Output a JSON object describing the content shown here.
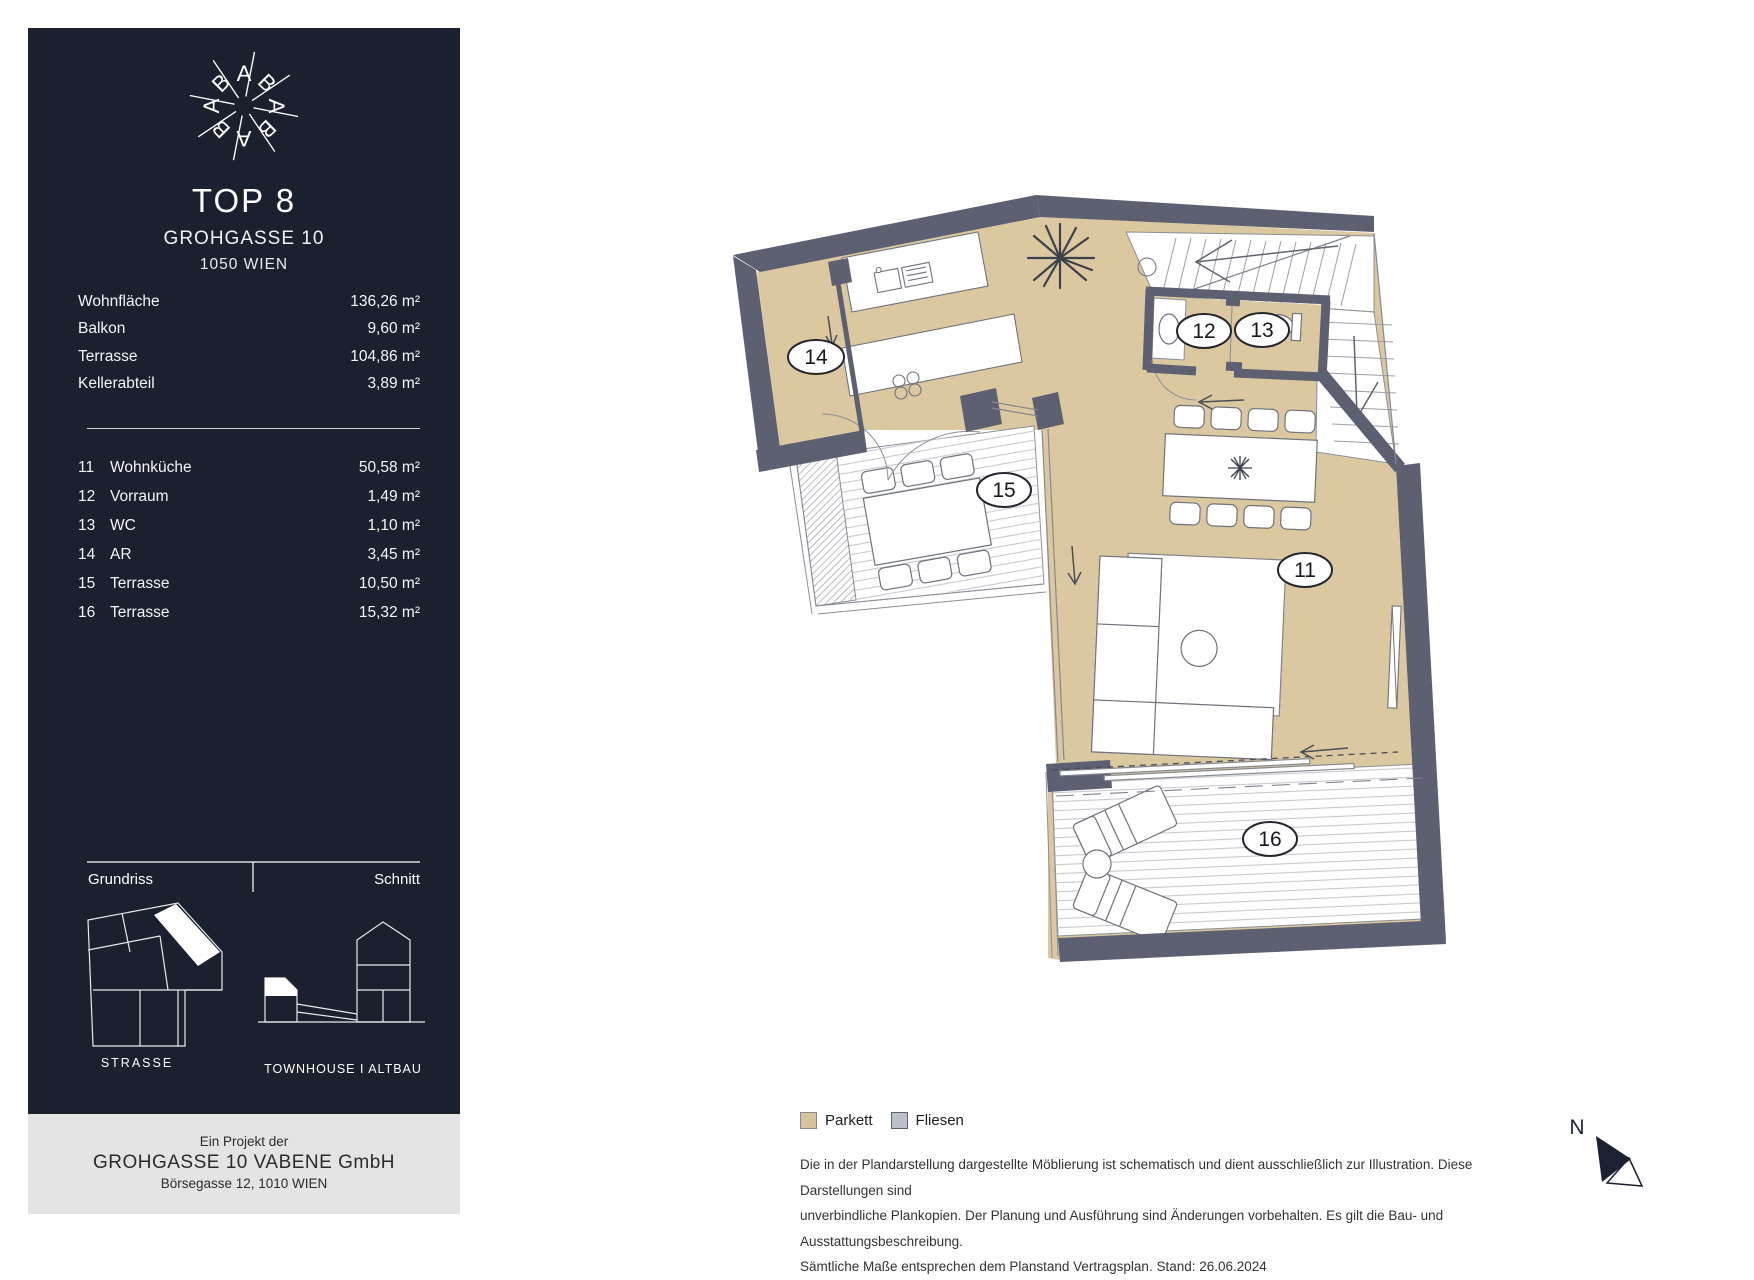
{
  "sidebar": {
    "logo": {
      "letters": [
        "A",
        "B",
        "A",
        "B",
        "A",
        "B",
        "A",
        "B"
      ]
    },
    "title": "TOP 8",
    "subtitle": "GROHGASSE 10",
    "city": "1050 WIEN",
    "areas": [
      {
        "label": "Wohnfläche",
        "value": "136,26 m²"
      },
      {
        "label": "Balkon",
        "value": "9,60 m²"
      },
      {
        "label": "Terrasse",
        "value": "104,86 m²"
      },
      {
        "label": "Kellerabteil",
        "value": "3,89 m²"
      }
    ],
    "rooms": [
      {
        "no": "11",
        "label": "Wohnküche",
        "value": "50,58 m²"
      },
      {
        "no": "12",
        "label": "Vorraum",
        "value": "1,49 m²"
      },
      {
        "no": "13",
        "label": "WC",
        "value": "1,10 m²"
      },
      {
        "no": "14",
        "label": "AR",
        "value": "3,45 m²"
      },
      {
        "no": "15",
        "label": "Terrasse",
        "value": "10,50 m²"
      },
      {
        "no": "16",
        "label": "Terrasse",
        "value": "15,32 m²"
      }
    ],
    "section": {
      "left_label": "Grundriss",
      "right_label": "Schnitt",
      "strasse": "STRASSE",
      "townhouse": "TOWNHOUSE  I  ALTBAU"
    }
  },
  "footer": {
    "intro": "Ein Projekt der",
    "company": "GROHGASSE 10 VABENE GmbH",
    "address": "Börsegasse 12, 1010 WIEN"
  },
  "plan": {
    "room_tags": {
      "t11": "11",
      "t12": "12",
      "t13": "13",
      "t14": "14",
      "t15": "15",
      "t16": "16"
    },
    "legend": [
      {
        "label": "Parkett",
        "color": "#d7c49d"
      },
      {
        "label": "Fliesen",
        "color": "#bcc0c8"
      }
    ],
    "disclaimer": [
      "Die in der Plandarstellung dargestellte Möblierung ist schematisch und dient ausschließlich zur Illustration. Diese Darstellungen sind",
      "unverbindliche Plankopien. Der Planung und Ausführung sind Änderungen vorbehalten. Es gilt die Bau- und Ausstattungsbeschreibung.",
      "Sämtliche Maße entsprechen dem Planstand Vertragsplan. Stand: 26.06.2024"
    ],
    "north": {
      "label": "N"
    },
    "colors": {
      "parkett": "#dbc8a1",
      "wall": "#5c6070",
      "sidebar": "#1b202e",
      "fliesen": "#bcc0c8"
    }
  }
}
